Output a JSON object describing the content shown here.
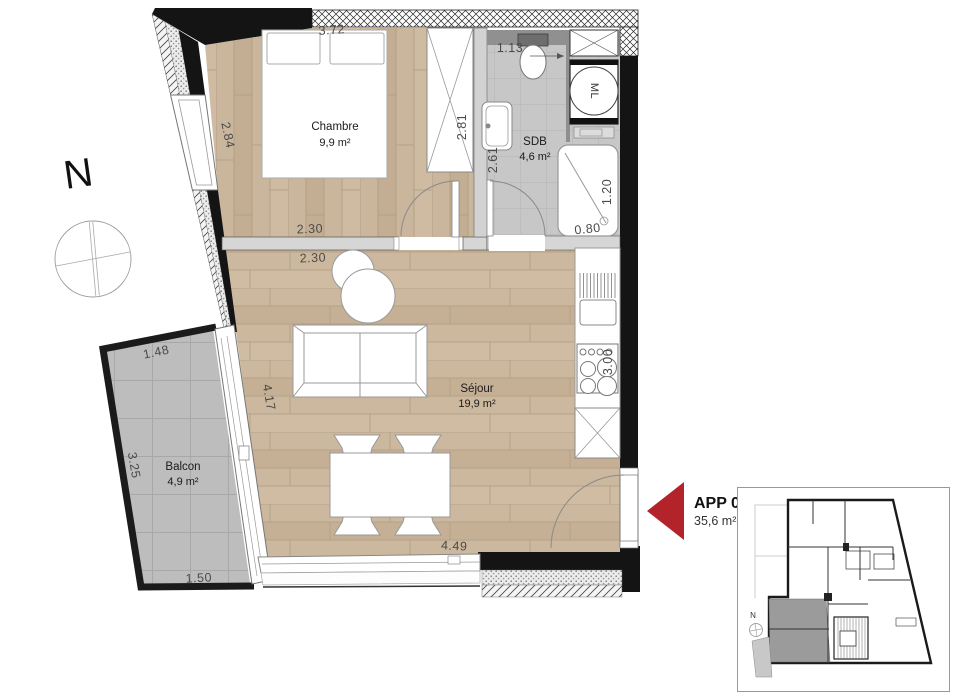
{
  "compass": {
    "letter": "N"
  },
  "rooms": {
    "chambre": {
      "name": "Chambre",
      "area": "9,9 m²"
    },
    "sdb": {
      "name": "SDB",
      "area": "4,6 m²"
    },
    "sejour": {
      "name": "Séjour",
      "area": "19,9 m²"
    },
    "balcon": {
      "name": "Balcon",
      "area": "4,9 m²"
    }
  },
  "dims": {
    "bed_wall": "3.72",
    "sdb_top": "1.13",
    "chambre_left": "2.84",
    "wardrobe": "2.81",
    "sdb_left": "2.61",
    "shower_length": "1.20",
    "shower_width": "0.80",
    "partition_top": "2.30",
    "partition_bottom": "2.30",
    "balcony_top": "1.48",
    "balcony_left": "3.25",
    "sejour_left": "4.17",
    "kitchen": "3.00",
    "sejour_bottom": "4.49",
    "balcony_bottom": "1.50"
  },
  "appliances": {
    "washing_machine": "ML"
  },
  "callout": {
    "label": "APP 06",
    "area": "35,6 m²"
  },
  "inset": {
    "compass_letter": "N"
  },
  "colors": {
    "accent_red": "#b2232a",
    "wall_black": "#141414"
  }
}
